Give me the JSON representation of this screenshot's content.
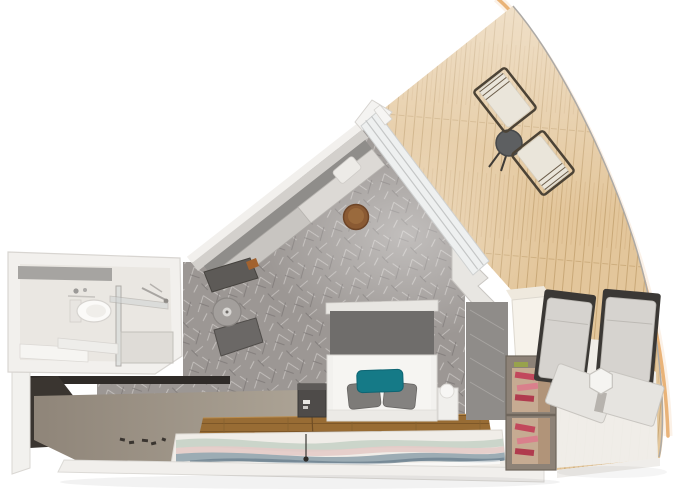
{
  "scene": {
    "label": "cruise-ship-cabin-3d-floorplan",
    "view": "aerial-cutaway-render"
  },
  "palette": {
    "hull_accent": "#e9b378",
    "deck_wood": "#e3c69b",
    "deck_plank_line": "#c9a877",
    "carpet": "#9c9794",
    "wall_white": "#f2f0ed",
    "wall_gray": "#d3d0cc",
    "corridor_dark": "#2f2b28",
    "corridor_floor": "#a79e93",
    "bathroom_floor": "#eae7e2",
    "accent_strip": "#a6a4a1",
    "sofa_back": "#8f8d8a",
    "sofa_seat": "#c8c5c1",
    "sofa_chaise": "#dcd9d5",
    "coffee_table": "#8a5a33",
    "armchair": "#5d5a57",
    "stool": "#a39f9c",
    "headboard": "#6f6d6b",
    "bed": "#f2f1ee",
    "pillow_gray": "#7d7b78",
    "pillow_teal": "#157a87",
    "nightstand_dark": "#4e4b49",
    "wood_floor": "#986c34",
    "rug_base": "#f0ede8",
    "rug_sage": "#c7d2c6",
    "rug_blush": "#e4cbc8",
    "rug_slate": "#97a9b1",
    "glass_wall": "#eef0f0",
    "closet_gray": "#8f8c89",
    "cabinet_cream": "#f6f2ea",
    "shelf_frame": "#8d8277",
    "shelf_inner": "#c6ab92",
    "shoes_pink": "#c2485c",
    "lounger_cushion": "#d6d3cf",
    "lounger_frame": "#3b3835",
    "lounger_flap": "#e6e4e0",
    "chair_cushion": "#eae5da",
    "chair_frame": "#4c4336",
    "bistro_table": "#5d5f61",
    "side_table": "#f5f4f1"
  },
  "inventory": {
    "bathroom": [
      "toilet",
      "washbasin",
      "glass-shower",
      "shower-tray"
    ],
    "entry": [
      "corridor"
    ],
    "bedroom": [
      "sofa",
      "chaise-cushion",
      "coffee-table",
      "armchair",
      "footstool",
      "double-bed",
      "headboard",
      "teal-accent-pillow",
      "nightstand-left",
      "nightstand-right",
      "floor-lamp",
      "area-rug",
      "wardrobe",
      "shoe-shelf"
    ],
    "balcony": [
      "deck-chair-1",
      "deck-chair-2",
      "bistro-table",
      "sun-lounger-1",
      "sun-lounger-2",
      "side-table"
    ]
  }
}
